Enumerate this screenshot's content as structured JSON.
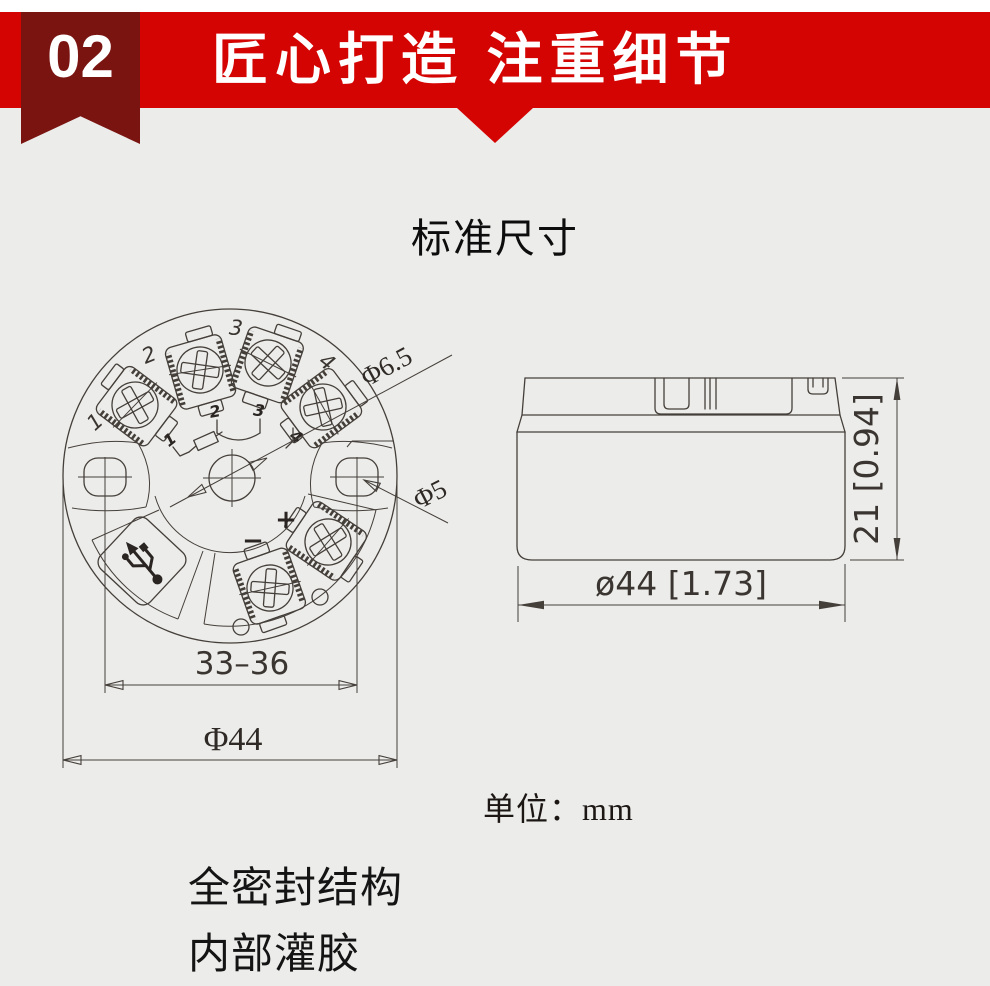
{
  "colors": {
    "banner_red": "#d40402",
    "ribbon_dark": "#7a1411",
    "background": "#ececea",
    "drawing_line": "#453f3a",
    "text_dark": "#141414",
    "white": "#ffffff"
  },
  "header": {
    "badge_number": "02",
    "banner_title": "匠心打造 注重细节"
  },
  "content": {
    "section_title": "标准尺寸",
    "unit_note": "单位：mm",
    "feature_line1": "全密封结构",
    "feature_line2": "内部灌胶"
  },
  "top_view": {
    "terminal_labels": [
      "1",
      "2",
      "3",
      "4"
    ],
    "schematic_labels": [
      "1",
      "2",
      "3",
      "4"
    ],
    "polarity_plus": "+",
    "polarity_minus": "−",
    "dim_center_hole": "Φ6.5",
    "dim_side_hole": "Φ5",
    "dim_mount_span": "33–36",
    "dim_outer_diameter": "Φ44"
  },
  "side_view": {
    "dim_height": "21 [0.94]",
    "dim_diameter": "ø44 [1.73]"
  },
  "icons": {
    "usb_icon": "usb-trident"
  }
}
